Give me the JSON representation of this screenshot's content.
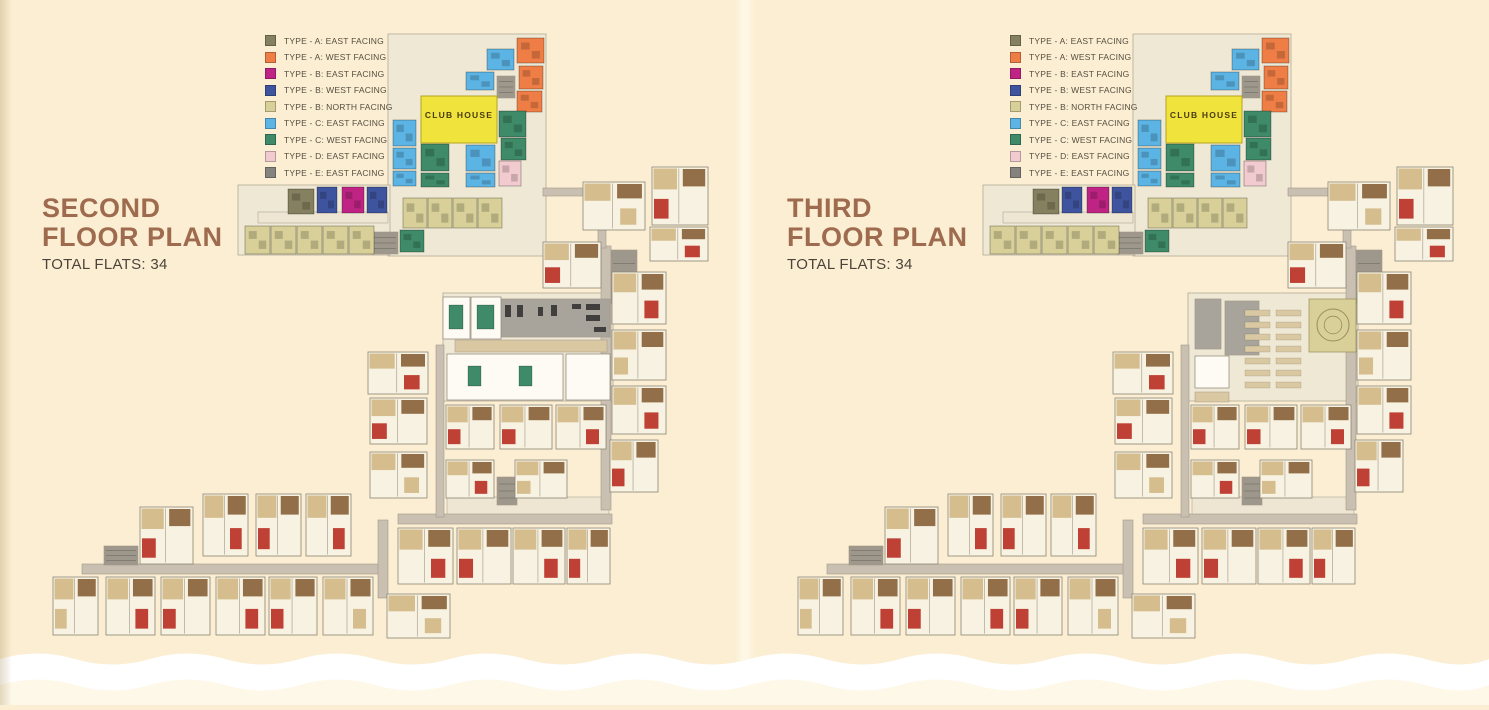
{
  "pages": [
    {
      "title_line1": "SECOND",
      "title_line2": "FLOOR PLAN",
      "subtitle": "TOTAL FLATS: 34",
      "amenity_variant": "gym"
    },
    {
      "title_line1": "THIRD",
      "title_line2": "FLOOR PLAN",
      "subtitle": "TOTAL FLATS: 34",
      "amenity_variant": "theatre"
    }
  ],
  "clubhouse": {
    "label": "CLUB HOUSE",
    "rect": [
      421,
      96,
      76,
      47
    ]
  },
  "legend": {
    "items": [
      {
        "label": "TYPE - A: EAST FACING",
        "color": "#85805f"
      },
      {
        "label": "TYPE - A: WEST FACING",
        "color": "#ef7e46"
      },
      {
        "label": "TYPE - B: EAST FACING",
        "color": "#bf2484"
      },
      {
        "label": "TYPE - B: WEST FACING",
        "color": "#3f549e"
      },
      {
        "label": "TYPE - B: NORTH FACING",
        "color": "#d8d098"
      },
      {
        "label": "TYPE - C: EAST FACING",
        "color": "#5cb4e4"
      },
      {
        "label": "TYPE - C: WEST FACING",
        "color": "#3f8a68"
      },
      {
        "label": "TYPE - D: EAST FACING",
        "color": "#f2cbd0"
      },
      {
        "label": "TYPE - E: EAST FACING",
        "color": "#84837e"
      }
    ]
  },
  "colors": {
    "page_bg": "#fbeed3",
    "page_bg_bottom": "#fdf8e8",
    "wave": "#ffffff",
    "title": "#9e6b4f",
    "subtitle": "#4c443a",
    "legend_text": "#564e40",
    "underlay": "#efe8d4",
    "underlay_stroke": "#b3aa95",
    "corridor": "#c9c0b2",
    "corridor_stroke": "#a3988a",
    "stair": "#9e978b",
    "flat_fill": "#f7f2e2",
    "flat_stroke": "#8d8474",
    "furn_tan": "#d5bd8e",
    "furn_brown": "#926f48",
    "furn_red": "#bf4135",
    "light_strip": "#eee6d2",
    "clubhouse_fill": "#f0e33b",
    "clubhouse_stroke": "#b3a41f",
    "clubhouse_text": "#4a3c14",
    "gray_room": "#a8a49c",
    "tan_room": "#d9c8a2",
    "khaki": "#d8d098",
    "circle_stroke": "#9a8d5a",
    "green": "#3f8a68",
    "white_room": "#fdfbf4"
  },
  "plan": {
    "underlays": [
      [
        388,
        34,
        158,
        222
      ],
      [
        238,
        185,
        152,
        70
      ],
      [
        443,
        293,
        170,
        108
      ]
    ],
    "light_strips": [
      [
        258,
        212,
        130,
        11
      ],
      [
        447,
        497,
        162,
        18
      ]
    ],
    "corridors": [
      [
        601,
        246,
        10,
        264
      ],
      [
        398,
        514,
        214,
        10
      ],
      [
        82,
        564,
        298,
        10
      ],
      [
        378,
        520,
        10,
        78
      ],
      [
        543,
        188,
        60,
        8
      ],
      [
        598,
        192,
        8,
        56
      ],
      [
        436,
        345,
        8,
        172
      ]
    ],
    "stairs": [
      [
        611,
        250,
        26,
        54
      ],
      [
        497,
        477,
        20,
        28
      ],
      [
        104,
        546,
        34,
        19
      ],
      [
        497,
        76,
        18,
        22
      ],
      [
        372,
        232,
        26,
        22
      ]
    ],
    "flats": [
      [
        583,
        182,
        62,
        48
      ],
      [
        652,
        167,
        56,
        58
      ],
      [
        650,
        227,
        58,
        34
      ],
      [
        543,
        242,
        58,
        46
      ],
      [
        612,
        272,
        54,
        52
      ],
      [
        612,
        330,
        54,
        50
      ],
      [
        612,
        386,
        54,
        48
      ],
      [
        610,
        440,
        48,
        52
      ],
      [
        368,
        352,
        60,
        42
      ],
      [
        370,
        398,
        57,
        46
      ],
      [
        370,
        452,
        57,
        46
      ],
      [
        446,
        405,
        48,
        44
      ],
      [
        446,
        460,
        48,
        38
      ],
      [
        500,
        405,
        52,
        44
      ],
      [
        556,
        405,
        50,
        44
      ],
      [
        515,
        460,
        52,
        38
      ],
      [
        398,
        528,
        55,
        56
      ],
      [
        457,
        528,
        54,
        56
      ],
      [
        513,
        528,
        52,
        56
      ],
      [
        567,
        528,
        43,
        56
      ],
      [
        387,
        594,
        63,
        44
      ],
      [
        140,
        507,
        53,
        57
      ],
      [
        203,
        494,
        45,
        62
      ],
      [
        256,
        494,
        45,
        62
      ],
      [
        306,
        494,
        45,
        62
      ],
      [
        53,
        577,
        45,
        58
      ],
      [
        106,
        577,
        49,
        58
      ],
      [
        161,
        577,
        49,
        58
      ],
      [
        216,
        577,
        49,
        58
      ],
      [
        269,
        577,
        48,
        58
      ],
      [
        323,
        577,
        50,
        58
      ]
    ],
    "color_blocks": [
      [
        288,
        189,
        26,
        25,
        0
      ],
      [
        317,
        187,
        20,
        26,
        3
      ],
      [
        342,
        187,
        22,
        26,
        2
      ],
      [
        367,
        187,
        20,
        26,
        3
      ],
      [
        245,
        226,
        25,
        28,
        4
      ],
      [
        271,
        226,
        25,
        28,
        4
      ],
      [
        297,
        226,
        25,
        28,
        4
      ],
      [
        323,
        226,
        25,
        28,
        4
      ],
      [
        349,
        226,
        25,
        28,
        4
      ],
      [
        517,
        38,
        27,
        25,
        1
      ],
      [
        519,
        66,
        24,
        23,
        1
      ],
      [
        517,
        91,
        25,
        21,
        1
      ],
      [
        487,
        49,
        27,
        21,
        5
      ],
      [
        466,
        72,
        28,
        18,
        5
      ],
      [
        393,
        120,
        23,
        26,
        5
      ],
      [
        393,
        148,
        23,
        21,
        5
      ],
      [
        393,
        171,
        23,
        15,
        5
      ],
      [
        466,
        145,
        29,
        26,
        5
      ],
      [
        466,
        173,
        29,
        14,
        5
      ],
      [
        499,
        111,
        27,
        26,
        6
      ],
      [
        501,
        138,
        25,
        22,
        6
      ],
      [
        421,
        144,
        28,
        27,
        6
      ],
      [
        421,
        173,
        28,
        14,
        6
      ],
      [
        400,
        230,
        24,
        22,
        6
      ],
      [
        499,
        161,
        22,
        25,
        7
      ],
      [
        403,
        198,
        24,
        30,
        4
      ],
      [
        428,
        198,
        24,
        30,
        4
      ],
      [
        453,
        198,
        24,
        30,
        4
      ],
      [
        478,
        198,
        24,
        30,
        4
      ]
    ],
    "amenity_gym": {
      "gray_room": [
        497,
        299,
        113,
        38
      ],
      "white_rooms": [
        [
          443,
          297,
          27,
          42
        ],
        [
          471,
          297,
          30,
          42
        ],
        [
          447,
          354,
          116,
          46
        ],
        [
          566,
          354,
          44,
          46
        ]
      ],
      "tan_corridor": [
        455,
        340,
        152,
        12
      ],
      "green_tables": [
        [
          449,
          305,
          14,
          24
        ],
        [
          477,
          305,
          17,
          24
        ],
        [
          468,
          366,
          13,
          20
        ],
        [
          519,
          366,
          13,
          20
        ]
      ],
      "equipment": [
        [
          505,
          305,
          6,
          12
        ],
        [
          517,
          305,
          6,
          12
        ],
        [
          538,
          307,
          5,
          9
        ],
        [
          551,
          305,
          6,
          11
        ],
        [
          572,
          304,
          9,
          5
        ],
        [
          586,
          304,
          14,
          6
        ],
        [
          586,
          315,
          14,
          6
        ],
        [
          594,
          327,
          12,
          5
        ]
      ]
    },
    "amenity_theatre": {
      "gray_rooms": [
        [
          450,
          299,
          26,
          50
        ],
        [
          480,
          301,
          34,
          54
        ]
      ],
      "white_rooms": [
        [
          450,
          356,
          34,
          32
        ]
      ],
      "tan_rooms": [
        [
          450,
          392,
          34,
          10
        ]
      ],
      "seats": {
        "x": 500,
        "y": 310,
        "rows": 7,
        "cols": 2,
        "dx": 31,
        "dy": 12,
        "w": 25,
        "h": 6
      },
      "khaki_hall": [
        564,
        299,
        47,
        53
      ],
      "circle": {
        "cx": 588,
        "cy": 325,
        "r": 16
      }
    }
  }
}
